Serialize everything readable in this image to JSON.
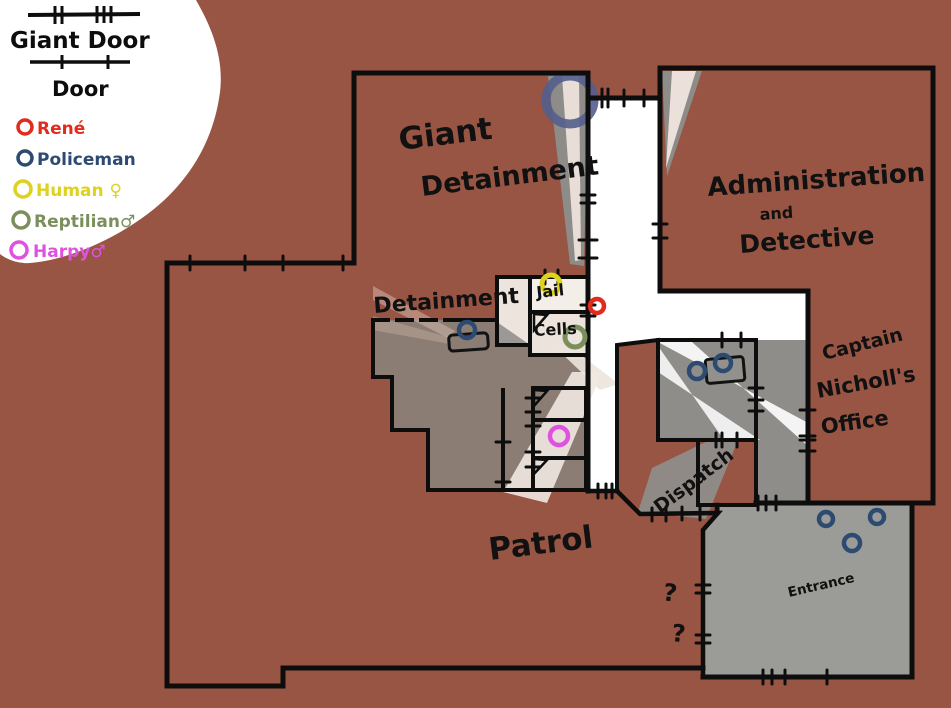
{
  "legend": {
    "giant_door_label": "Giant Door",
    "door_label": "Door",
    "entries": [
      {
        "label": "René",
        "color": "#e22b1f"
      },
      {
        "label": "Policeman",
        "color": "#2d4b70"
      },
      {
        "label": "Human ♀",
        "color": "#ddd21e"
      },
      {
        "label": "Reptilian♂",
        "color": "#7a8f5c"
      },
      {
        "label": "Harpy♂",
        "color": "#df52df"
      }
    ]
  },
  "rooms": {
    "giant_detainment_line1": "Giant",
    "giant_detainment_line2": "Detainment",
    "administration_line1": "Administration",
    "administration_line2": "and",
    "administration_line3": "Detective",
    "detainment": "Detainment",
    "jail_line1": "Jail",
    "jail_line2": "Cells",
    "captain_line1": "Captain",
    "captain_line2": "Nicholl's",
    "captain_line3": "Office",
    "dispatch": "Dispatch",
    "patrol": "Patrol",
    "entrance": "Entrance"
  },
  "annotations": {
    "question_mark_1": "?",
    "question_mark_2": "?"
  },
  "colors": {
    "background": "#995544",
    "rene": "#e22b1f",
    "policeman": "#2d4b70",
    "giant_policeman": "#535e8d",
    "human": "#ddd21e",
    "reptilian": "#7a8f5c",
    "harpy": "#df52df"
  }
}
